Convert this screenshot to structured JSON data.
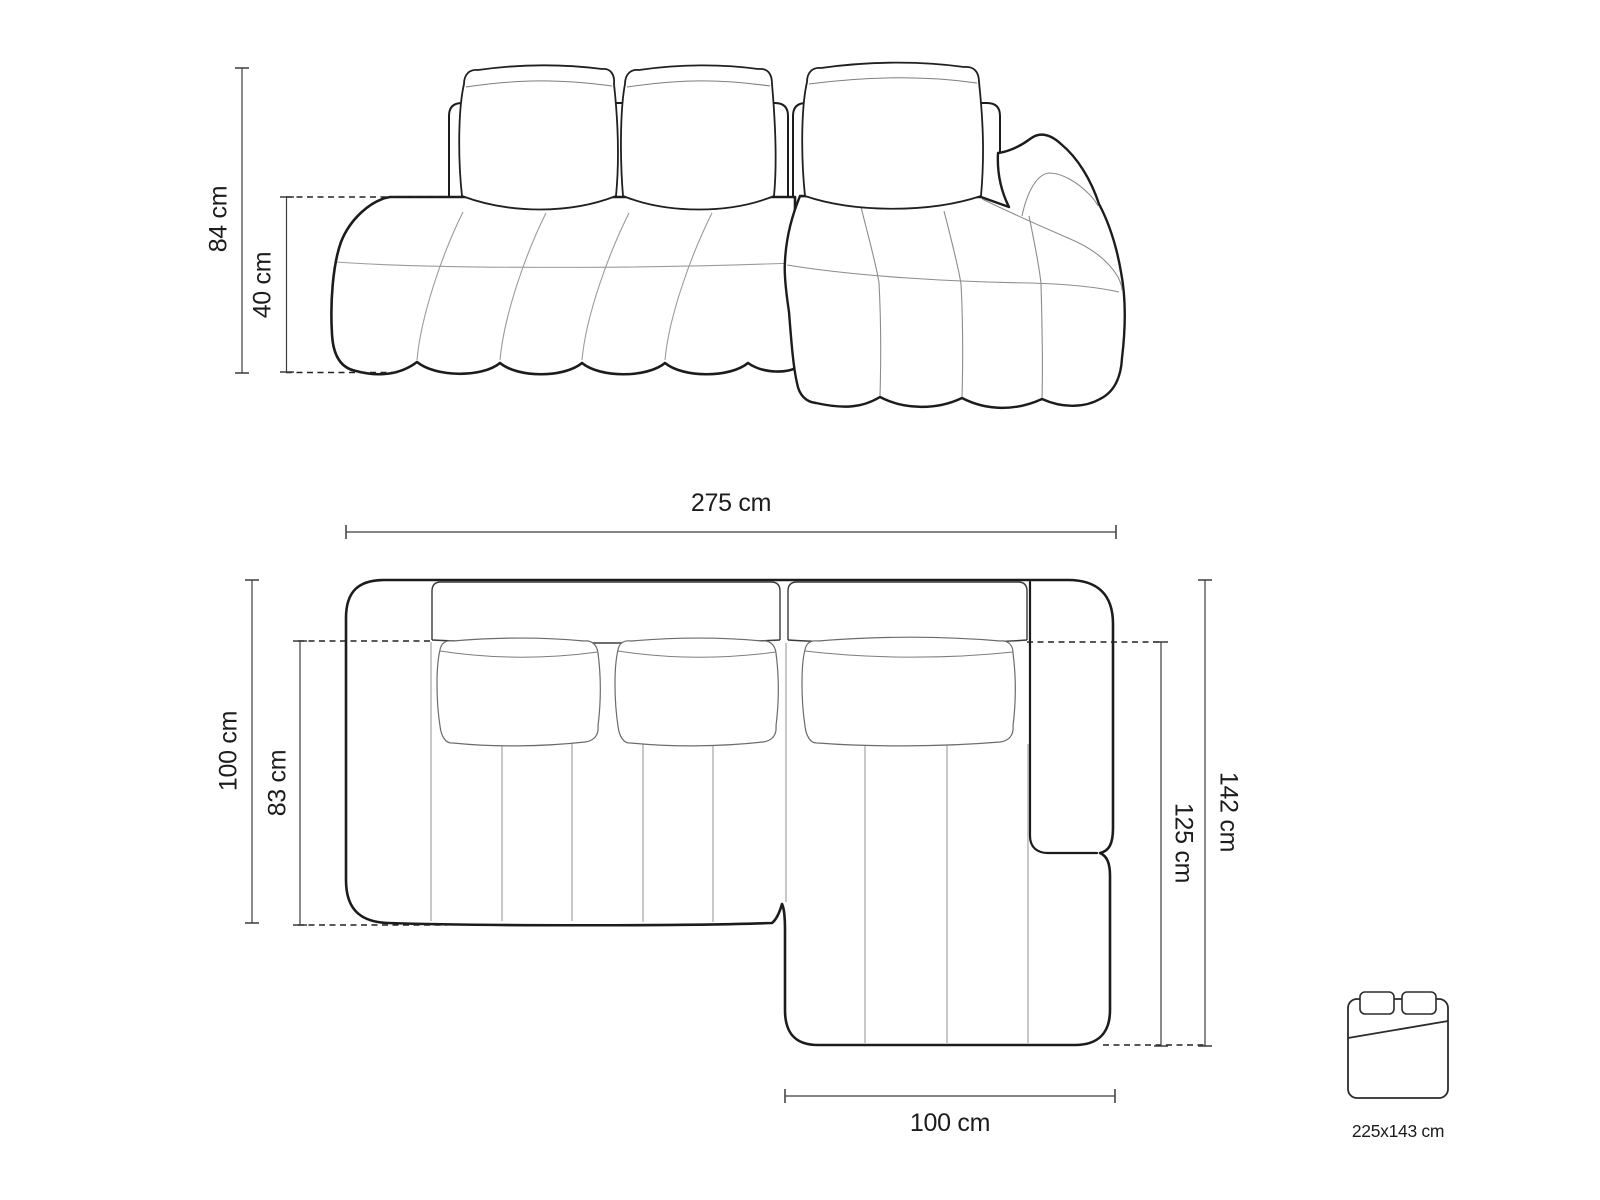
{
  "figure": {
    "type": "sofa-dimension-diagram",
    "views": [
      "front-elevation",
      "top-plan"
    ],
    "background": "#ffffff"
  },
  "front_view": {
    "total_height": "84 cm",
    "seat_height": "40 cm"
  },
  "top_view": {
    "total_width": "275 cm",
    "side_depth": "100 cm",
    "seat_depth": "83 cm",
    "total_depth": "142 cm",
    "chaise_depth": "125 cm",
    "chaise_width": "100 cm"
  },
  "sleeping_area": {
    "size": "225x143 cm"
  },
  "colors": {
    "outline": "#1c1c1c",
    "seam": "#9b9b9b",
    "dimension": "#3c3c3c",
    "background": "#ffffff"
  }
}
